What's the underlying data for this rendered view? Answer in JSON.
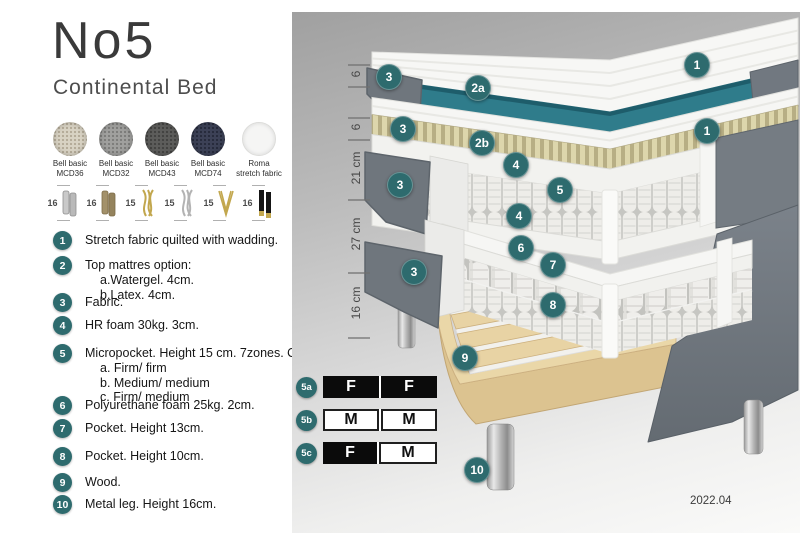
{
  "header": {
    "title": "No5",
    "subtitle": "Continental Bed"
  },
  "fabrics": [
    {
      "line1": "Bell basic",
      "line2": "MCD36"
    },
    {
      "line1": "Bell basic",
      "line2": "MCD32"
    },
    {
      "line1": "Bell basic",
      "line2": "MCD43"
    },
    {
      "line1": "Bell basic",
      "line2": "MCD74"
    },
    {
      "line1": "Roma",
      "line2": "stretch fabric"
    }
  ],
  "leg_options": [
    {
      "size": "16",
      "style": "cylinder-silver"
    },
    {
      "size": "16",
      "style": "cylinder-bronze"
    },
    {
      "size": "15",
      "style": "twisted-gold"
    },
    {
      "size": "15",
      "style": "twisted-silver"
    },
    {
      "size": "15",
      "style": "hairpin-gold"
    },
    {
      "size": "16",
      "style": "black-gold-tip"
    }
  ],
  "parts_list": [
    {
      "num": "1",
      "text": "Stretch fabric quilted with wadding.",
      "subs": []
    },
    {
      "num": "2",
      "text": "Top mattres option:",
      "subs": [
        "a.Watergel. 4cm.",
        "b.Latex. 4cm."
      ]
    },
    {
      "num": "3",
      "text": "Fabric.",
      "subs": []
    },
    {
      "num": "4",
      "text": "HR foam 30kg. 3cm.",
      "subs": []
    },
    {
      "num": "5",
      "text": "Micropocket. Height 15 cm. 7zones. Option:",
      "subs": [
        "a. Firm/ firm",
        "b. Medium/ medium",
        "c. Firm/ medium"
      ]
    },
    {
      "num": "6",
      "text": "Polyurethane foam 25kg. 2cm.",
      "subs": []
    },
    {
      "num": "7",
      "text": "Pocket. Height 13cm.",
      "subs": []
    },
    {
      "num": "8",
      "text": "Pocket. Height 10cm.",
      "subs": []
    },
    {
      "num": "9",
      "text": "Wood.",
      "subs": []
    },
    {
      "num": "10",
      "text": "Metal leg. Height 16cm.",
      "subs": []
    }
  ],
  "diagram": {
    "badges": [
      "1",
      "3",
      "2a",
      "3",
      "2b",
      "1",
      "4",
      "5",
      "3",
      "4",
      "6",
      "3",
      "7",
      "8",
      "9",
      "10"
    ],
    "dimensions": [
      "6",
      "6",
      "21 cm",
      "27 cm",
      "16 cm"
    ],
    "firmness_rows": [
      {
        "label": "5a",
        "cell1": "F",
        "cell2": "F"
      },
      {
        "label": "5b",
        "cell1": "M",
        "cell2": "M"
      },
      {
        "label": "5c",
        "cell1": "F",
        "cell2": "M"
      }
    ],
    "version": "2022.04"
  },
  "colors": {
    "badge_teal": "#2e6b6e",
    "layer_teal": "#2f7c8b",
    "fabric_gray": "#747b82",
    "latex_beige": "#d9d2aa",
    "wood": "#e6d3a8"
  }
}
